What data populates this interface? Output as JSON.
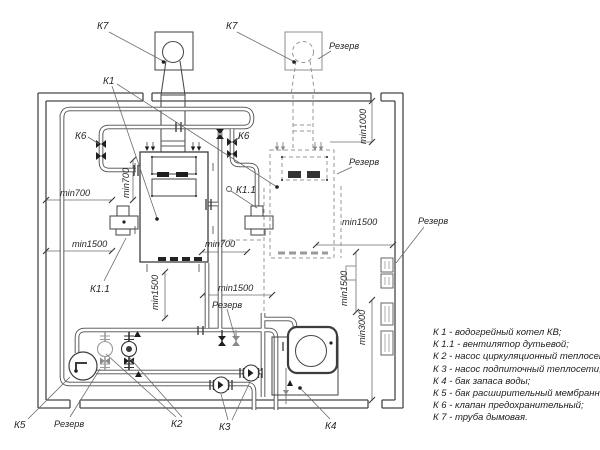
{
  "plan": {
    "equipment_labels": {
      "k7_left": "К7",
      "k7_right": "К7",
      "k1": "К1",
      "k6_left": "К6",
      "k6_right": "К6",
      "k11_mid": "К1.1",
      "k11_bottom": "К1.1",
      "k2": "К2",
      "k3": "К3",
      "k4": "К4",
      "k5": "К5"
    },
    "dimensions": {
      "min700_left": "min700",
      "min1500_left": "min1500",
      "min700_left_vert": "min700",
      "min700_mid": "min700",
      "min1500_mid": "min1500",
      "min1500_mid_vert": "min1500",
      "min1500_right": "min1500",
      "min1500_right_vert": "min1500",
      "min1000_vert": "min1000",
      "min3000_vert": "min3000"
    },
    "reserve_labels": {
      "chimney": "Резерв",
      "boiler": "Резерв",
      "panels": "Резерв",
      "pump_k2": "Резерв",
      "valves": "Резерв"
    }
  },
  "legend": {
    "items": [
      "К 1 -  водогрейный котел КВ;",
      "К 1.1 -  вентилятор дутьевой;",
      "К 2 -  насос циркуляционный теплосети;",
      "К 3 -  насос подпиточный теплосети;",
      "К 4 -  бак запаса воды;",
      "К 5 -  бак расширительный мембранный;",
      "К 6 -  клапан предохранительный;",
      "К 7 -  труба дымовая."
    ]
  }
}
